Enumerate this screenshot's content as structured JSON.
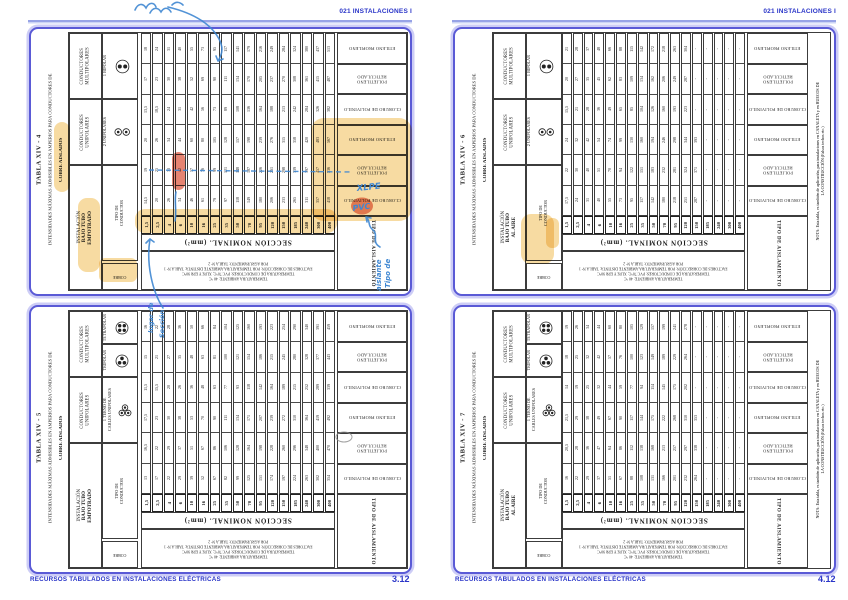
{
  "page_header": {
    "title": "021 INSTALACIONES I"
  },
  "footer": {
    "label": "RECURSOS TABULADOS EN INSTALACIONES ELÉCTRICAS",
    "page_number_left": "3.12",
    "page_number_right": "4.12"
  },
  "colors": {
    "accent_blue": "#2a35c8",
    "rule_blue": "#97a3e6",
    "box_blue": "#5a5ad6",
    "ink_blue": "#3f87d2",
    "highlight_yellow": "#f1be55",
    "red_mark": "#e0654f",
    "table_ink": "#1d1d1d"
  },
  "shared": {
    "subtitle": "INTENSIDADES MÁXIMAS ADMISIBLES EN AMPERIOS PARA CONDUCTORES DE",
    "subtitle2": "COBRE AISLADOS",
    "sections": [
      "1,5",
      "2,5",
      "4",
      "6",
      "10",
      "16",
      "25",
      "35",
      "50",
      "70",
      "95",
      "120",
      "150",
      "185",
      "240",
      "300",
      "400"
    ],
    "seccion_caption": "SECCIÓN NOMINAL.  (mm²)",
    "tipo_aislamiento": "TIPO DE AISLAMIENTO",
    "insulation_labels": [
      [
        "ETILENO PROPILENO"
      ],
      [
        "POLIETILENO",
        "RETICULADO"
      ],
      [
        "CLORURO DE POLIVINILO"
      ],
      [
        "ETILENO PROPILENO"
      ],
      [
        "POLIETILENO",
        "RETICULADO"
      ],
      [
        "CLORURO DE POLIVINILO"
      ]
    ],
    "group_multi": [
      "CONDUCTORES",
      "MULTIPOLARES"
    ],
    "group_uni": [
      "CONDUCTORES",
      "UNIPOLARES"
    ],
    "tipo_conductor": [
      "TIPO DE",
      "CONDUCTOR"
    ],
    "small_cell": "COBRE",
    "notes": [
      "TEMPERATURA AMBIENTE: 40 °C",
      "TEMPERATURA DE CONDUCTORES: PVC 70°C; XLPE Y EPR 90°C",
      "FACTORES DE CORRECCIÓN:  POR TEMPERATURA AMBIENTE DISTINTA: TABLA Nº 1",
      "POR AGRUPAMIENTO: TABLA Nº 2"
    ],
    "nota_side": [
      "NOTA: Esta tabla, es también de aplicación, para instalaciones en CANALETA y en HUECOS DE",
      "LA CONSTRUCCIÓN (Falsos techos etc.)"
    ]
  },
  "tables": [
    {
      "id": "XIV-4",
      "page": 0,
      "slot": 0,
      "title": "TABLA XIV - 4",
      "installation": [
        "INSTALACIÓN",
        "BAJO TUBO",
        "EMPOTRADO"
      ],
      "has_nota": false,
      "sub_multi": [
        {
          "lines": [
            "1 BIPOLAR"
          ],
          "icon": "bipolar"
        }
      ],
      "sub_uni": {
        "lines": [
          "2 UNIPOLARES"
        ],
        "icon": "two-unipolar"
      },
      "rows": [
        [
          "18",
          "24",
          "31",
          "40",
          "55",
          "73",
          "95",
          "117",
          "141",
          "179",
          "216",
          "249",
          "284",
          "324",
          "380",
          "437",
          "513"
        ],
        [
          "17",
          "23",
          "30",
          "38",
          "52",
          "69",
          "90",
          "111",
          "134",
          "170",
          "205",
          "237",
          "270",
          "308",
          "361",
          "415",
          "487"
        ],
        [
          "13,5",
          "18,5",
          "24",
          "31",
          "42",
          "56",
          "73",
          "89",
          "108",
          "136",
          "164",
          "188",
          "213",
          "242",
          "284",
          "326",
          "382"
        ],
        [
          "20",
          "26",
          "34",
          "44",
          "60",
          "80",
          "105",
          "128",
          "157",
          "198",
          "239",
          "276",
          "315",
          "358",
          "420",
          "483",
          "567"
        ],
        [
          "19",
          "25",
          "33",
          "42",
          "57",
          "76",
          "99",
          "121",
          "148",
          "187",
          "226",
          "261",
          "298",
          "339",
          "397",
          "457",
          "536"
        ],
        [
          "14,5",
          "20",
          "26",
          "34",
          "46",
          "61",
          "79",
          "97",
          "118",
          "149",
          "180",
          "206",
          "233",
          "265",
          "311",
          "357",
          "418"
        ]
      ]
    },
    {
      "id": "XIV-5",
      "page": 0,
      "slot": 1,
      "title": "TABLA XIV - 5",
      "installation": [
        "INSTALACIÓN",
        "BAJO TUBO",
        "EMPOTRADO"
      ],
      "has_nota": false,
      "sub_multi": [
        {
          "lines": [
            "TETRAPOLAR"
          ],
          "icon": "tetrapolar"
        },
        {
          "lines": [
            "TRIPOLAR"
          ],
          "icon": "tripolar"
        }
      ],
      "sub_uni": {
        "lines": [
          "1 TERNO DE",
          "CABLES UNIPOLARES"
        ],
        "icon": "terno"
      },
      "rows": [
        [
          "16",
          "22",
          "28",
          "36",
          "50",
          "66",
          "84",
          "104",
          "125",
          "160",
          "193",
          "223",
          "254",
          "290",
          "340",
          "391",
          "459"
        ],
        [
          "15",
          "21",
          "27",
          "35",
          "48",
          "63",
          "81",
          "100",
          "121",
          "154",
          "186",
          "215",
          "245",
          "280",
          "328",
          "377",
          "443"
        ],
        [
          "11,5",
          "15,5",
          "20",
          "26",
          "36",
          "48",
          "63",
          "77",
          "93",
          "118",
          "142",
          "164",
          "189",
          "215",
          "252",
          "289",
          "339"
        ],
        [
          "17,5",
          "23",
          "30",
          "38",
          "53",
          "70",
          "90",
          "111",
          "134",
          "171",
          "207",
          "239",
          "272",
          "310",
          "364",
          "419",
          "492"
        ],
        [
          "16,5",
          "22",
          "29",
          "37",
          "51",
          "67",
          "86",
          "106",
          "128",
          "164",
          "198",
          "228",
          "260",
          "296",
          "348",
          "400",
          "470"
        ],
        [
          "13",
          "17",
          "22",
          "29",
          "39",
          "52",
          "67",
          "82",
          "99",
          "125",
          "151",
          "174",
          "197",
          "224",
          "263",
          "302",
          "354"
        ]
      ]
    },
    {
      "id": "XIV-6",
      "page": 1,
      "slot": 0,
      "title": "TABLA XIV - 6",
      "installation": [
        "INSTALACIÓN",
        "BAJO TUBO",
        "AL AIRE"
      ],
      "has_nota": true,
      "sub_multi": [
        {
          "lines": [
            "1 BIPOLAR"
          ],
          "icon": "bipolar"
        }
      ],
      "sub_uni": {
        "lines": [
          "2 UNIPOLARES"
        ],
        "icon": "two-unipolar"
      },
      "rows": [
        [
          "21",
          "28",
          "37",
          "48",
          "66",
          "88",
          "115",
          "142",
          "172",
          "218",
          "263",
          "304",
          "-",
          "-",
          "-",
          "-",
          "-"
        ],
        [
          "20",
          "27",
          "35",
          "45",
          "62",
          "83",
          "109",
          "134",
          "162",
          "206",
          "249",
          "287",
          "-",
          "-",
          "-",
          "-",
          "-"
        ],
        [
          "15,5",
          "21",
          "28",
          "36",
          "49",
          "65",
          "85",
          "104",
          "126",
          "160",
          "193",
          "223",
          "-",
          "-",
          "-",
          "-",
          "-"
        ],
        [
          "24",
          "32",
          "42",
          "54",
          "74",
          "99",
          "130",
          "160",
          "194",
          "246",
          "298",
          "344",
          "393",
          "-",
          "-",
          "-",
          "-"
        ],
        [
          "22",
          "30",
          "40",
          "51",
          "70",
          "94",
          "122",
          "151",
          "183",
          "232",
          "281",
          "324",
          "371",
          "-",
          "-",
          "-",
          "-"
        ],
        [
          "17,5",
          "24",
          "31",
          "40",
          "55",
          "73",
          "95",
          "117",
          "142",
          "180",
          "218",
          "251",
          "287",
          "-",
          "-",
          "-",
          "-"
        ]
      ]
    },
    {
      "id": "XIV-7",
      "page": 1,
      "slot": 1,
      "title": "TABLA XIV - 7",
      "installation": [
        "INSTALACIÓN",
        "BAJO TUBO",
        "AL AIRE"
      ],
      "has_nota": true,
      "sub_multi": [
        {
          "lines": [
            "TETRAPOLAR"
          ],
          "icon": "tetrapolar"
        },
        {
          "lines": [
            "TRIPOLAR"
          ],
          "icon": "tripolar"
        }
      ],
      "sub_uni": {
        "lines": [
          "1 TERNO DE",
          "CABLES UNIPOLARES"
        ],
        "icon": "terno"
      },
      "rows": [
        [
          "19",
          "26",
          "34",
          "44",
          "60",
          "80",
          "105",
          "129",
          "157",
          "199",
          "241",
          "278",
          "-",
          "-",
          "-",
          "-",
          "-"
        ],
        [
          "18",
          "25",
          "32",
          "42",
          "57",
          "76",
          "100",
          "123",
          "149",
          "189",
          "229",
          "264",
          "-",
          "-",
          "-",
          "-",
          "-"
        ],
        [
          "14",
          "19",
          "25",
          "32",
          "44",
          "59",
          "77",
          "94",
          "114",
          "145",
          "175",
          "202",
          "-",
          "-",
          "-",
          "-",
          "-"
        ],
        [
          "21,5",
          "29",
          "38",
          "49",
          "67",
          "90",
          "117",
          "144",
          "175",
          "222",
          "268",
          "310",
          "353",
          "-",
          "-",
          "-",
          "-"
        ],
        [
          "20,5",
          "28",
          "36",
          "47",
          "64",
          "86",
          "112",
          "138",
          "168",
          "213",
          "257",
          "297",
          "338",
          "-",
          "-",
          "-",
          "-"
        ],
        [
          "16",
          "22",
          "29",
          "37",
          "51",
          "67",
          "88",
          "108",
          "131",
          "166",
          "201",
          "232",
          "264",
          "-",
          "-",
          "-",
          "-"
        ]
      ]
    }
  ],
  "annotations": {
    "highlights": [
      {
        "x": 54,
        "y": 122,
        "w": 16,
        "h": 70,
        "r": 8
      },
      {
        "x": 78,
        "y": 198,
        "w": 22,
        "h": 74,
        "r": 9
      },
      {
        "x": 99,
        "y": 258,
        "w": 38,
        "h": 24,
        "r": 6
      },
      {
        "x": 135,
        "y": 209,
        "w": 202,
        "h": 24,
        "r": 10
      },
      {
        "x": 311,
        "y": 118,
        "w": 101,
        "h": 103,
        "r": 13
      },
      {
        "x": 521,
        "y": 214,
        "w": 33,
        "h": 50,
        "r": 10
      },
      {
        "x": 546,
        "y": 218,
        "w": 13,
        "h": 30,
        "r": 6
      }
    ],
    "red_marks": [
      {
        "type": "rect",
        "x": 172,
        "y": 152,
        "w": 13,
        "h": 38,
        "r": 6.5
      },
      {
        "type": "ellipse",
        "cx": 362,
        "cy": 206,
        "rx": 11,
        "ry": 8.5
      }
    ],
    "pencil_circles": [
      {
        "cx": 344,
        "cy": 437,
        "rx": 8,
        "ry": 5
      }
    ],
    "ink": {
      "paths": [
        "M135,10 c3,-7 8,-7 11,-2 c3,-6 8,-6 10,-1 M150,13 c3,-6 8,-6 11,-1 c3,-5 7,-5 10,0 M172,5 c4,-4 8,-3 11,0",
        "M168,7 C197,14 213,26 220,41 C224,50 221,56 218,61 M218,61 l-2,-5 M218,61 l5,-2",
        "M176,192 c-2,9 1,18 -1,29",
        "M163,308 C152,291 146,263 150,239 M150,239 l-4,4 M150,239 l4,3",
        "M380,247 c-9,-5 -1,-12 -7,-17 c-6,-5 -2,-9 -7,-13 M366,217 l1,5 M366,217 l5,1"
      ],
      "dashed_paths": [
        "M149,170 L352,172"
      ],
      "texts": [
        {
          "t": "XLPE",
          "x": 357,
          "y": 191,
          "rot": -6,
          "size": 8.5
        },
        {
          "t": "PVC",
          "x": 353,
          "y": 211,
          "rot": -8,
          "size": 8
        },
        {
          "t": "Tipo de",
          "x": 390,
          "y": 288,
          "rot": -90,
          "size": 7
        },
        {
          "t": "aislante",
          "x": 381,
          "y": 291,
          "rot": -90,
          "size": 7
        },
        {
          "t": "lugar de",
          "x": 153,
          "y": 333,
          "rot": -90,
          "size": 6.5
        },
        {
          "t": "Sección",
          "x": 164,
          "y": 338,
          "rot": -90,
          "size": 6.5
        }
      ]
    }
  }
}
